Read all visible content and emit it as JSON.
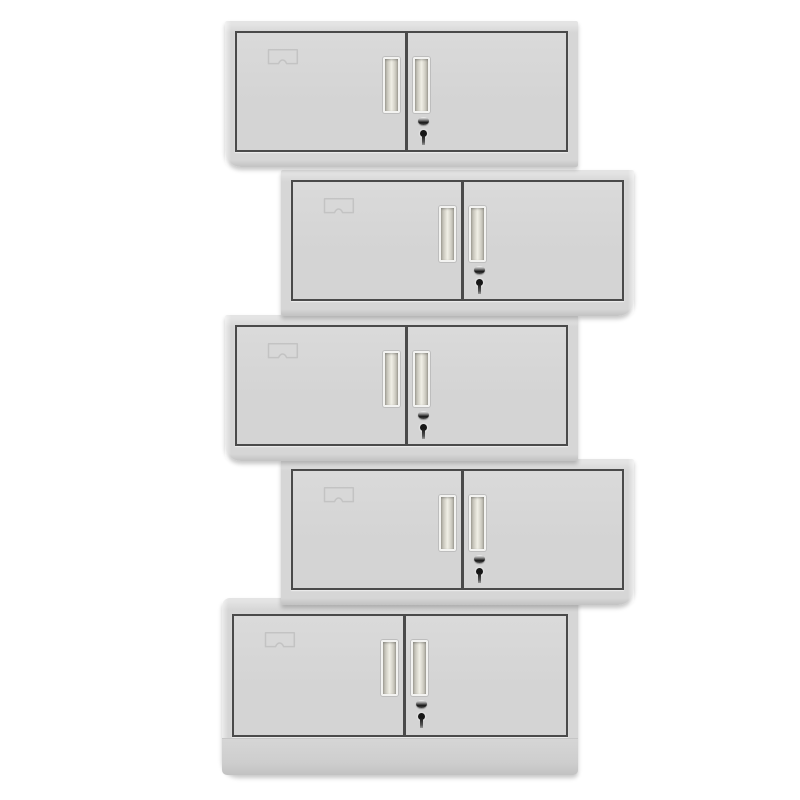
{
  "meta": {
    "description": "Product photograph of five identical two-door steel office cupboards stacked in an alternating zig-zag column on a plain white background",
    "unit_count": 5,
    "doors_per_unit": 2
  },
  "palette": {
    "bg": "#ffffff",
    "frame": "#d6d6d6",
    "frame-hi": "#e4e4e4",
    "frame-lo": "#c2c2c2",
    "door": "#d4d4d4",
    "door-hi": "#dadada",
    "door-border": "#4a4a4a",
    "handle-frame": "#f3f3f1",
    "handle-dark": "#b0aea4",
    "handle-mid": "#d8d6cc",
    "handle-light": "#f0efe6",
    "lock-dark": "#161616",
    "emboss": "#c3c3c3"
  },
  "cabinets": [
    {
      "id": "cabinet-unit-1",
      "offset": "left",
      "base": false,
      "features": {
        "label_holder": true,
        "handles": 2,
        "lock": true
      }
    },
    {
      "id": "cabinet-unit-2",
      "offset": "right",
      "base": false,
      "features": {
        "label_holder": true,
        "handles": 2,
        "lock": true
      }
    },
    {
      "id": "cabinet-unit-3",
      "offset": "left",
      "base": false,
      "features": {
        "label_holder": true,
        "handles": 2,
        "lock": true
      }
    },
    {
      "id": "cabinet-unit-4",
      "offset": "right",
      "base": false,
      "features": {
        "label_holder": true,
        "handles": 2,
        "lock": true
      }
    },
    {
      "id": "cabinet-unit-5",
      "offset": "left",
      "base": true,
      "features": {
        "label_holder": true,
        "handles": 2,
        "lock": true
      }
    }
  ]
}
